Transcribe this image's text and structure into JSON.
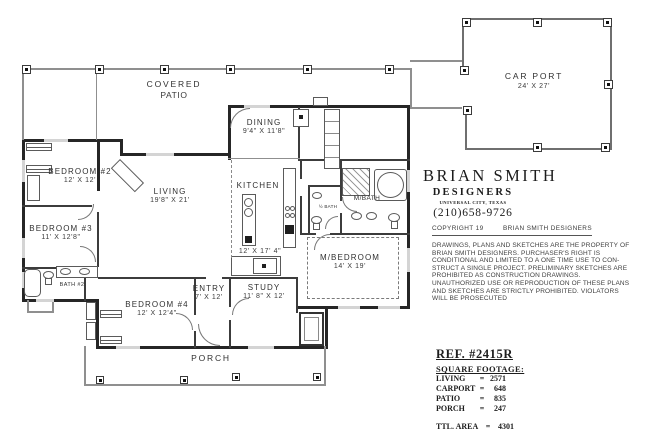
{
  "sheet": {
    "rooms": {
      "covered_patio": {
        "line1": "COVERED",
        "line2": "PATIO"
      },
      "carport": {
        "name": "CAR PORT",
        "dims": "24' X 27'"
      },
      "dining": {
        "name": "DINING",
        "dims": "9'4\" X 11'8\""
      },
      "bedroom2": {
        "name": "BEDROOM #2",
        "dims": "12' X 12'"
      },
      "living": {
        "name": "LIVING",
        "dims": "19'8\" X 21'"
      },
      "kitchen": {
        "name": "KITCHEN",
        "dims": "12' X 17' 4\""
      },
      "bedroom3": {
        "name": "BEDROOM #3",
        "dims": "11' X 12'8\""
      },
      "bath2": {
        "name": "BATH #2"
      },
      "half_bath": {
        "name": "½ BATH"
      },
      "master_bath": {
        "name": "M/BATH"
      },
      "bedroom4": {
        "name": "BEDROOM #4",
        "dims": "12' X 12'4\""
      },
      "entry": {
        "name": "ENTRY",
        "dims": "7' X 12'"
      },
      "study": {
        "name": "STUDY",
        "dims": "11' 8\" X 12'"
      },
      "master_bedroom": {
        "name": "M/BEDROOM",
        "dims": "14' X 19'"
      },
      "porch": {
        "name": "PORCH"
      }
    },
    "designer": {
      "firm_name": "BRIAN SMITH",
      "firm_type": "DESIGNERS",
      "location": "UNIVERSAL CITY, TEXAS",
      "phone": "(210)658-9726",
      "copyright_prefix": "COPYRIGHT 19",
      "copyright_holder": "BRIAN SMITH DESIGNERS",
      "disclaimer": "DRAWINGS, PLANS AND SKETCHES ARE THE PROPERTY OF BRIAN SMITH DESIGNERS.  PURCHASER'S RIGHT IS CONDITIONAL AND LIMITED TO A ONE TIME USE TO CON- STRUCT A SINGLE PROJECT.  PRELIMINARY SKETCHES ARE PROHIBITED AS CONSTRUCTION DRAWINGS.  UNAUTHORIZED USE OR REPRODUCTION OF THESE PLANS AND SKETCHES ARE STRICTLY PROHIBITED.  VIOLATORS WILL BE PROSECUTED"
    },
    "reference": {
      "ref_number": "REF. #2415R",
      "table_title": "SQUARE FOOTAGE:",
      "equals": "=",
      "rows": [
        {
          "label": "LIVING",
          "value": "2571"
        },
        {
          "label": "CARPORT",
          "value": "648"
        },
        {
          "label": "PATIO",
          "value": "835"
        },
        {
          "label": "PORCH",
          "value": "247"
        }
      ],
      "total_label": "TTL. AREA",
      "total_value": "4301"
    }
  }
}
